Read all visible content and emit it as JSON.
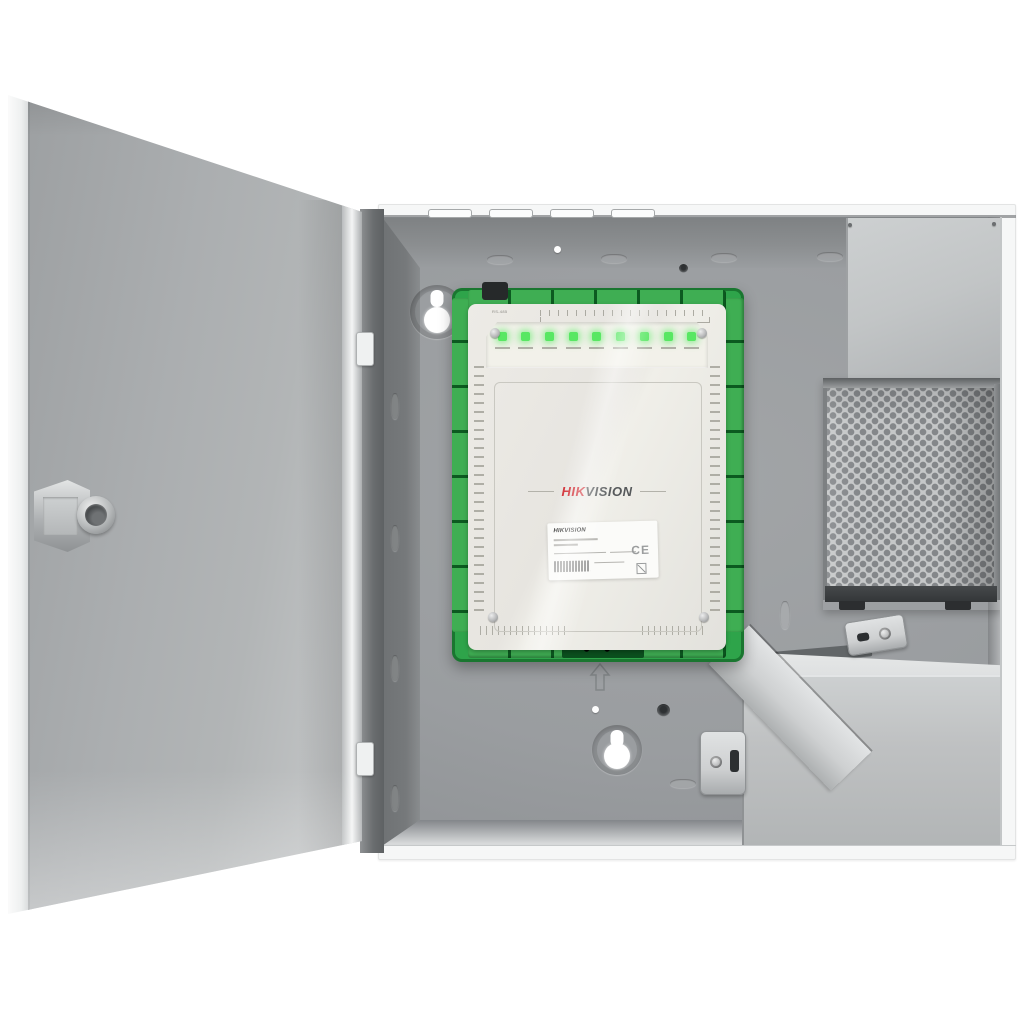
{
  "product": {
    "brand_hik": "HIK",
    "brand_vision": "VISION",
    "cover_port_label": "RS-485",
    "sticker": {
      "title": "HIKVISION",
      "ce_mark": "CE"
    },
    "leds": {
      "count": 9
    }
  },
  "colors": {
    "bg": "#ffffff",
    "door_edge": "#eef0f0",
    "door_face_dark": "#9da0a2",
    "door_face": "#b2b5b6",
    "door_face_light": "#c9cbcc",
    "flange": "#f6f7f7",
    "strip_dark": "#6a6d6f",
    "top_wall": "#8b8e90",
    "wall_dark": "#76797b",
    "back_panel": "#9a9da0",
    "back_panel_deep": "#8a8d90",
    "bottom_wall": "#d7d9da",
    "pcb_green": "#2ea44a",
    "pcb_dark": "#156228",
    "terminal_green": "#3fae53",
    "terminal_gap": "#0c5a20",
    "cover": "#e7e5e0",
    "cover_recess": "#f2f1ea",
    "label_ink": "#a09f96",
    "led_green": "#58e763",
    "brand_red": "#d0252c",
    "brand_gray": "#55585a",
    "sticker_bg": "#fbfbf9",
    "psu_plate": "#c2c5c6",
    "psu_metal": "#c5c7c8",
    "psu_hole": "#84878a",
    "psu_dark": "#3c3f41",
    "battery_top": "#dadcdd",
    "battery_front": "#bfc1c2",
    "bracket_metal": "#ced0d1"
  }
}
